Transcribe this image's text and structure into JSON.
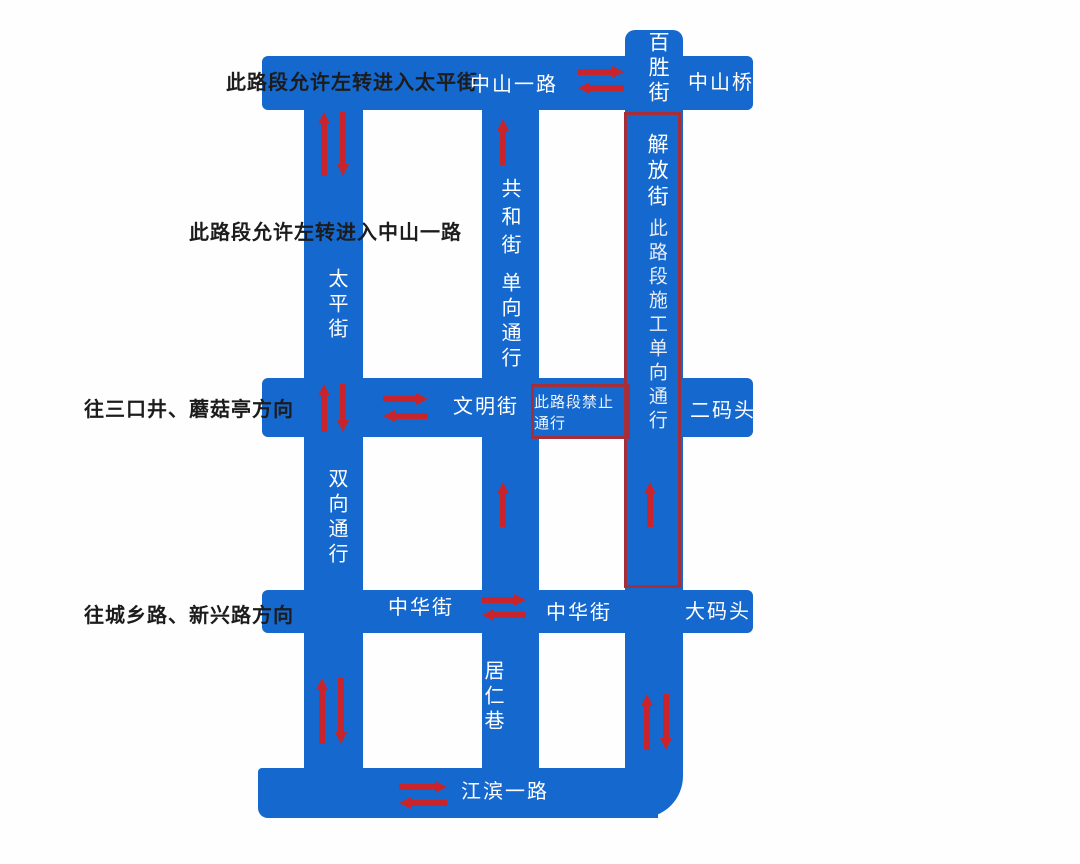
{
  "colors": {
    "road-blue": "#1568ce",
    "arrow-red": "#c8242c",
    "box-red": "#a52e38",
    "label-black": "#1c1c1c"
  },
  "annotations": {
    "allow_left_turn_taiping": "此路段允许左转进入太平街",
    "allow_left_turn_zhongshan": "此路段允许左转进入中山一路",
    "toward_sankoujing": "往三口井、蘑菇亭方向",
    "toward_chengxiang": "往城乡路、新兴路方向"
  },
  "streets": {
    "zhongshan_yilu": "中山一路",
    "zhongshan_qiao": "中山桥",
    "baisheng_jie": "百胜街",
    "jiefang_jie": "解放街",
    "jiefang_notice": "此路段施工单向通行",
    "taiping_jie": "太平街",
    "gonghe_jie": "共和街",
    "gonghe_notice": "单向通行",
    "wenming_jie": "文明街",
    "no_passage_notice": "此路段禁止通行",
    "ermatou": "二码头",
    "shuangxiang_notice": "双向通行",
    "zhonghua_jie_west": "中华街",
    "zhonghua_jie_east": "中华街",
    "damatou": "大码头",
    "juren_xiang": "居仁巷",
    "jiangbin_yilu": "江滨一路"
  },
  "arrows": [
    {
      "name": "zhongshan-yilu-eastbound",
      "dir": "right",
      "x": 578,
      "y": 66,
      "len": 46
    },
    {
      "name": "zhongshan-yilu-westbound",
      "dir": "left",
      "x": 578,
      "y": 82,
      "len": 46
    },
    {
      "name": "taiping-top-northbound",
      "dir": "up",
      "x": 318,
      "y": 112,
      "len": 64
    },
    {
      "name": "taiping-top-southbound",
      "dir": "down",
      "x": 337,
      "y": 112,
      "len": 64
    },
    {
      "name": "gonghe-top-northbound",
      "dir": "up",
      "x": 497,
      "y": 119,
      "len": 46
    },
    {
      "name": "taiping-mid-northbound",
      "dir": "up",
      "x": 318,
      "y": 384,
      "len": 48
    },
    {
      "name": "taiping-mid-southbound",
      "dir": "down",
      "x": 337,
      "y": 384,
      "len": 48
    },
    {
      "name": "wenming-eastbound",
      "dir": "right",
      "x": 383,
      "y": 393,
      "len": 45
    },
    {
      "name": "wenming-westbound",
      "dir": "left",
      "x": 383,
      "y": 410,
      "len": 45
    },
    {
      "name": "gonghe-mid-northbound",
      "dir": "up",
      "x": 497,
      "y": 482,
      "len": 45
    },
    {
      "name": "jiefang-mid-northbound",
      "dir": "up",
      "x": 644,
      "y": 482,
      "len": 45
    },
    {
      "name": "zhonghua-eastbound",
      "dir": "right",
      "x": 482,
      "y": 594,
      "len": 44
    },
    {
      "name": "zhonghua-westbound",
      "dir": "left",
      "x": 482,
      "y": 609,
      "len": 44
    },
    {
      "name": "taiping-bot-northbound",
      "dir": "up",
      "x": 316,
      "y": 678,
      "len": 66
    },
    {
      "name": "taiping-bot-southbound",
      "dir": "down",
      "x": 335,
      "y": 678,
      "len": 66
    },
    {
      "name": "jiefang-bot-northbound",
      "dir": "up",
      "x": 641,
      "y": 694,
      "len": 56
    },
    {
      "name": "jiefang-bot-southbound",
      "dir": "down",
      "x": 660,
      "y": 694,
      "len": 56
    },
    {
      "name": "jiangbin-eastbound",
      "dir": "right",
      "x": 399,
      "y": 781,
      "len": 48
    },
    {
      "name": "jiangbin-westbound",
      "dir": "left",
      "x": 399,
      "y": 797,
      "len": 48
    }
  ]
}
